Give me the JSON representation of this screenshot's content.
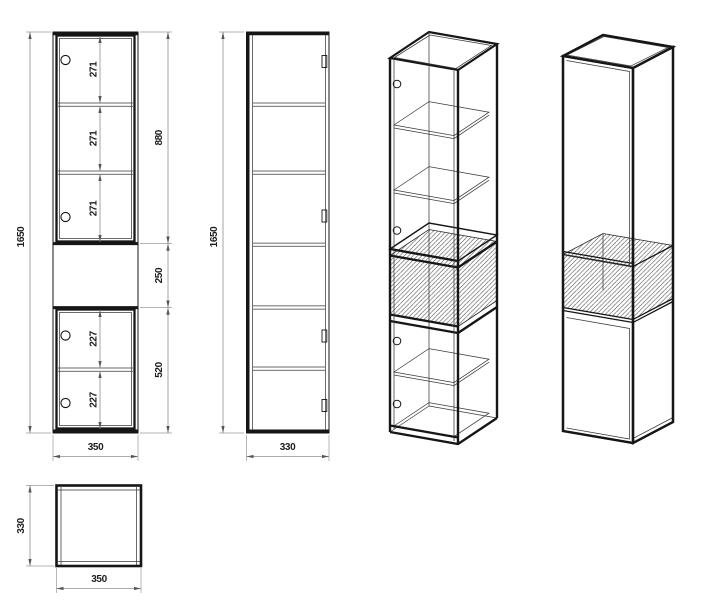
{
  "drawing": {
    "type": "furniture technical drawing - tall cabinet, 4 projections + top view",
    "palette": {
      "ink": "#161616",
      "dimension_lines": "#8f8f8f",
      "background": "#ffffff"
    },
    "views": {
      "front": {
        "dim_total_height": "1650",
        "dim_width": "350",
        "dim_upper_section": "880",
        "dim_niche": "250",
        "dim_lower_section": "520",
        "dim_shelf_1": "271",
        "dim_shelf_2": "271",
        "dim_shelf_3": "271",
        "dim_lower_shelf_1": "227",
        "dim_lower_shelf_2": "227"
      },
      "side": {
        "dim_height": "1650",
        "dim_depth": "330"
      },
      "top": {
        "dim_depth": "330",
        "dim_width": "350"
      }
    }
  }
}
